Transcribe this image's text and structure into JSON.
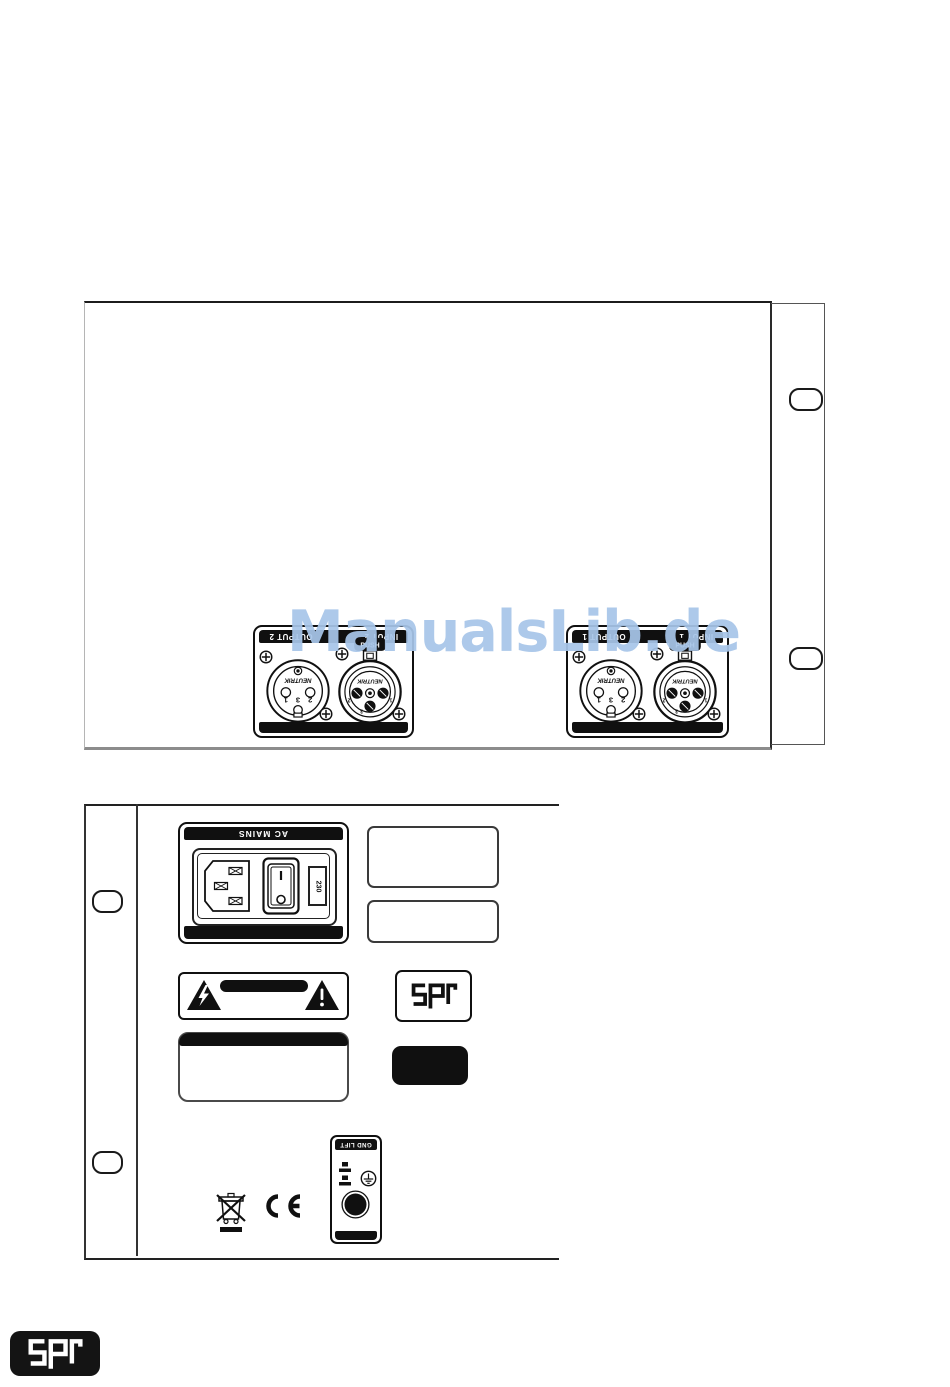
{
  "watermark": {
    "text": "ManualsLib.de",
    "color": "#a7c5e8"
  },
  "top_panel": {
    "plates": [
      {
        "output_label": "OUTPUT 2",
        "input_label": "INPUT 2",
        "brand": "NEUTRIK",
        "push_label": "PUSH",
        "male_pins": [
          "1",
          "3",
          "2"
        ],
        "female_pins": [
          "2",
          "1",
          "3"
        ]
      },
      {
        "output_label": "OUTPUT 1",
        "input_label": "INPUT 1",
        "brand": "NEUTRIK",
        "push_label": "PUSH",
        "male_pins": [
          "1",
          "3",
          "2"
        ],
        "female_pins": [
          "2",
          "1",
          "3"
        ]
      }
    ]
  },
  "bottom_panel": {
    "ac_mains": {
      "label": "AC MAINS",
      "fuse_rating": "230",
      "on_symbol": "I",
      "off_symbol": "O"
    },
    "gnd_lift": {
      "label": "GND LIFT"
    },
    "spl_badge_text": "spl",
    "ce_mark": "CE",
    "weee_icon": "weee-crossed-out-bin"
  },
  "footer_logo_text": "spl",
  "colors": {
    "line_art": "#101010",
    "watermark_blue": "#a7c5e8"
  }
}
